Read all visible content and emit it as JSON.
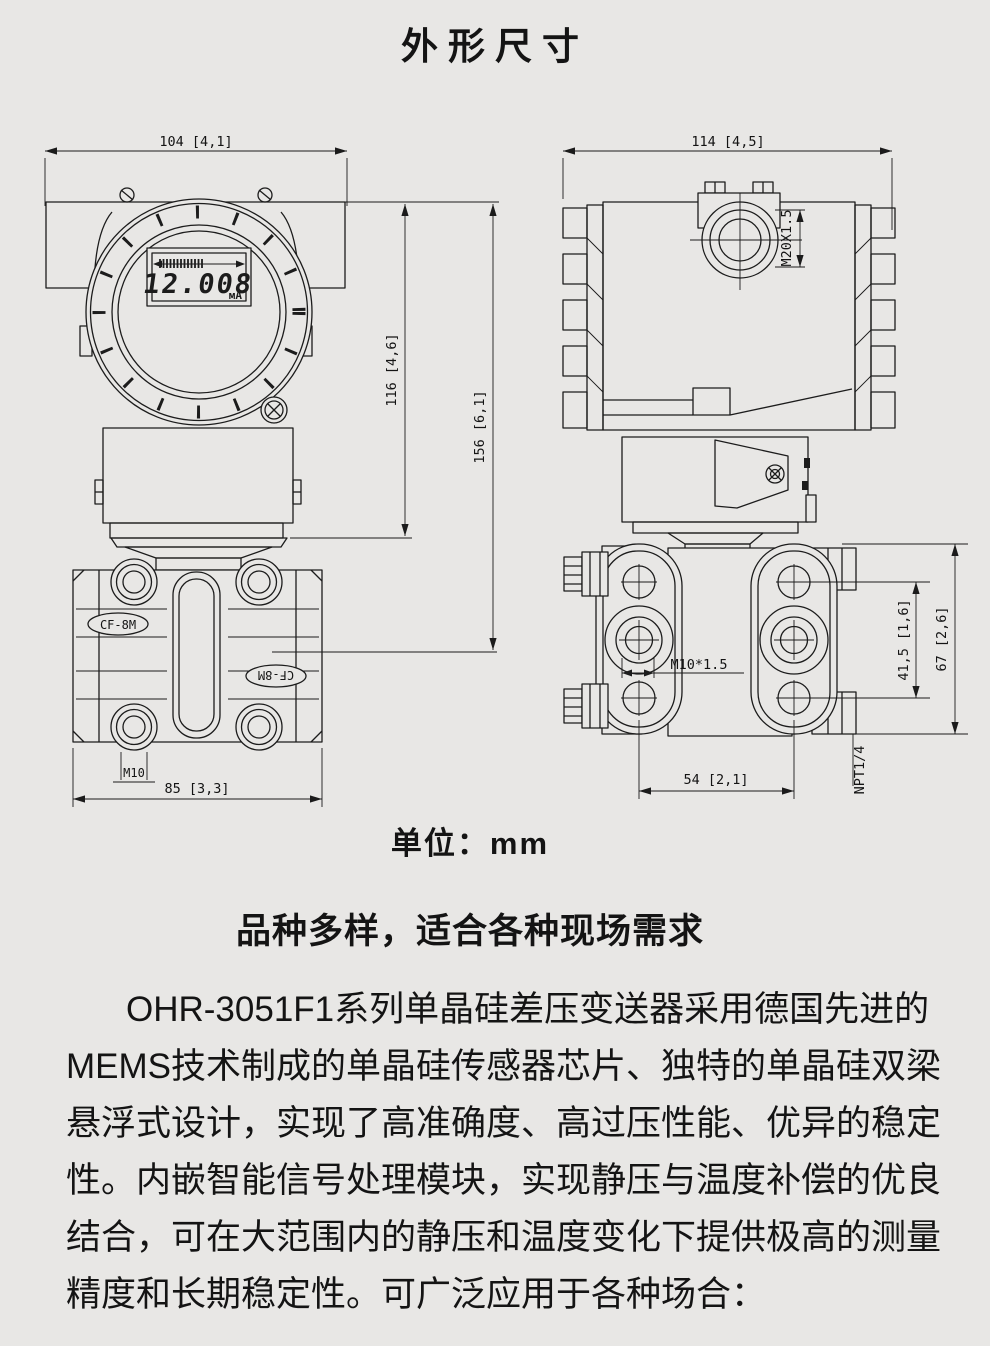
{
  "page": {
    "title": "外形尺寸",
    "unit_label": "单位：mm",
    "subtitle": "品种多样，适合各种现场需求",
    "paragraph_lines": [
      "OHR-3051F1系列单晶硅差压变送器采用德国先进的",
      "MEMS技术制成的单晶硅传感器芯片、独特的单晶硅双梁",
      "悬浮式设计，实现了高准确度、高过压性能、优异的稳定",
      "性。内嵌智能信号处理模块，实现静压与温度补偿的优良",
      "结合，可在大范围内的静压和温度变化下提供极高的测量",
      "精度和长期稳定性。可广泛应用于各种场合："
    ]
  },
  "front_view": {
    "dim_width": "104 [4,1]",
    "dim_housing_height": "116 [4,6]",
    "dim_total_height": "156 [6,1]",
    "dim_flange_width": "85 [3,3]",
    "bolt_thread_label": "M10",
    "flange_material_marking": "CF-8M",
    "lcd_value": "12.008",
    "lcd_unit": "мА"
  },
  "side_view": {
    "dim_width": "114 [4,5]",
    "conduit_thread_label": "M20X1.5",
    "bolt_thread_label": "M10*1.5",
    "dim_bolt_spacing": "54 [2,1]",
    "dim_bolt_row_spacing": "41,5 [1,6]",
    "dim_flange_height": "67 [2,6]",
    "drain_vent_thread_label": "NPT1/4"
  },
  "colors": {
    "background": "#e8e7e5",
    "line": "#1c1c1c",
    "text": "#141414"
  }
}
